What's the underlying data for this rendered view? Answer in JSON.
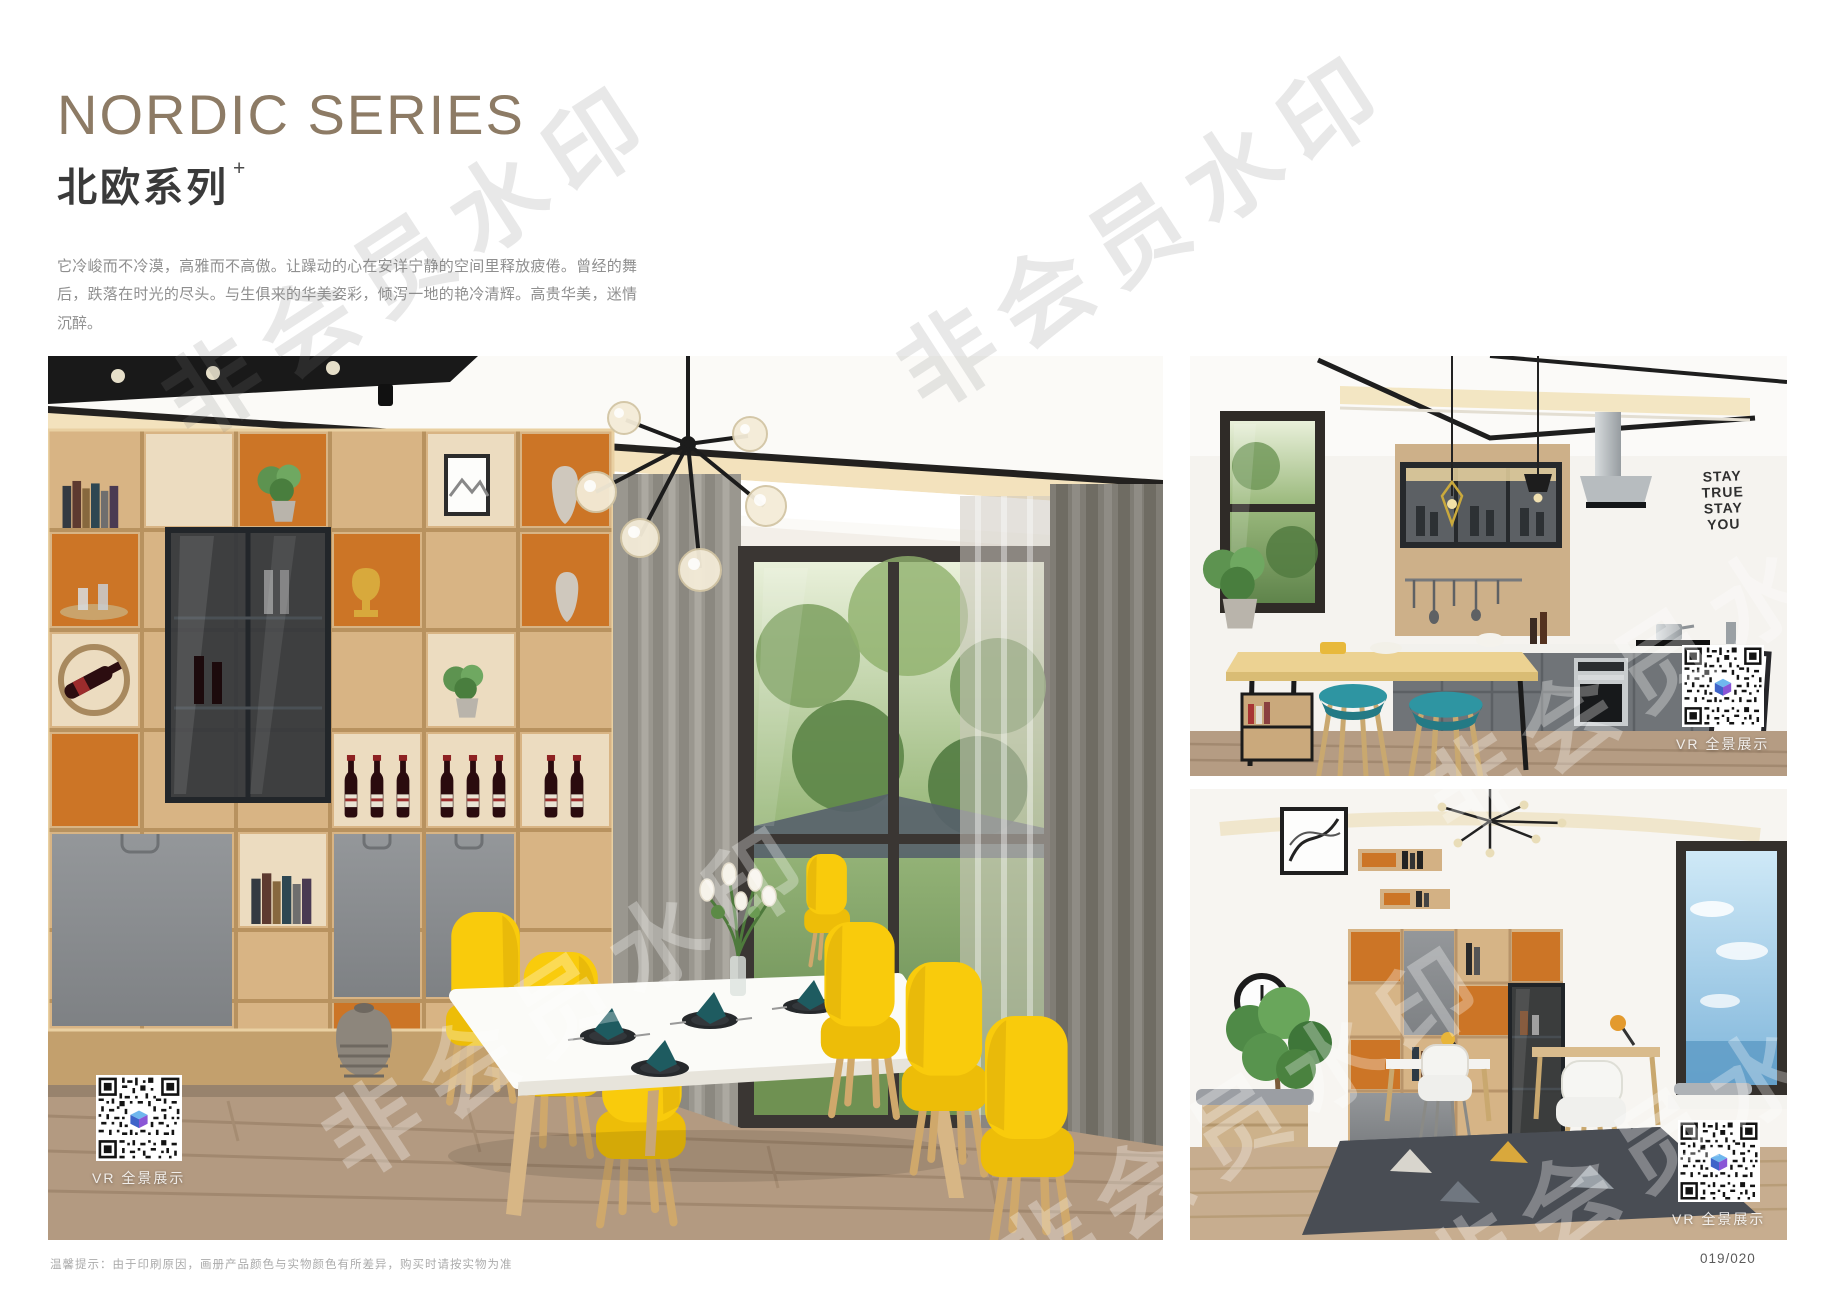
{
  "page": {
    "title_en": "NORDIC SERIES",
    "title_zh": "北欧系列",
    "title_plus": "+",
    "desc_zh": "它冷峻而不冷漠，高雅而不高傲。让躁动的心在安详宁静的空间里释放疲倦。曾经的舞后，跌落在时光的尽头。与生俱来的华美姿彩，倾泻一地的艳冷清辉。高贵华美，迷情沉醉。",
    "desc_en": "It is cold but not cold, elegant but not haughty. Let the restless heart in the space of peace and tranquility release fatigue. Once the Queen of Dance, fall in the end of time. The natural beauty of the beautiful, pouring a land of cold and pure brilliance. Noble, beautiful, enchanted.",
    "watermark_text": "非会员水印",
    "footer_note": "温馨提示：由于印刷原因，画册产品颜色与实物颜色有所差异，购买时请按实物为准",
    "page_number": "019/020"
  },
  "photos": {
    "vr_label": "VR 全景展示",
    "kitchen_decal_lines": [
      "STAY",
      "TRUE",
      "STAY",
      "YOU"
    ]
  },
  "colors": {
    "title_accent": "#8d7b65",
    "wood": "#d6b183",
    "orange_accent": "#cc7526",
    "chair_yellow": "#f6c90c",
    "stool_teal": "#2e95a2",
    "qr_logo_blue": "#4a78d8"
  }
}
